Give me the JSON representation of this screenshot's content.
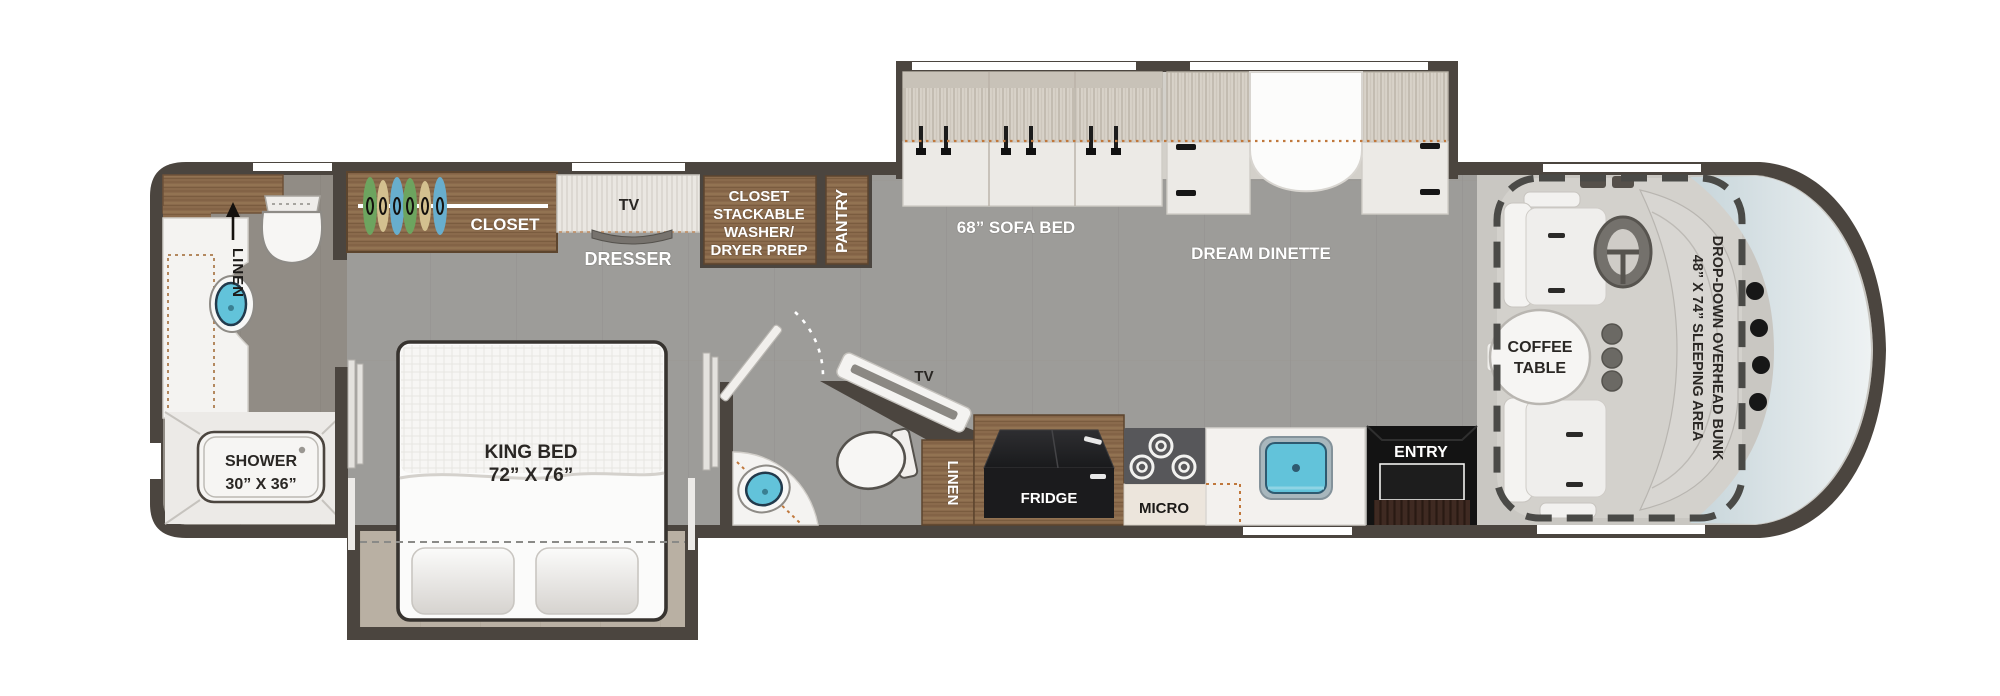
{
  "diagram": {
    "type": "rv-floorplan",
    "description": "Class A motorhome floor plan, side-aisle layout with two slide-outs"
  },
  "labels": {
    "rear_bath": {
      "linen": "LINEN",
      "shower_line1": "SHOWER",
      "shower_line2": "30” X 36”"
    },
    "bedroom": {
      "closet": "CLOSET",
      "tv": "TV",
      "dresser": "DRESSER",
      "king_line1": "KING BED",
      "king_line2": "72” X 76”"
    },
    "laundry": {
      "line1": "CLOSET",
      "line2": "STACKABLE",
      "line3": "WASHER/",
      "line4": "DRYER PREP",
      "pantry": "PANTRY"
    },
    "living": {
      "sofa": "68” SOFA BED",
      "dinette": "DREAM DINETTE"
    },
    "mid_bath": {
      "tv": "TV"
    },
    "kitchen": {
      "linen": "LINEN",
      "fridge": "FRIDGE",
      "micro": "MICRO",
      "entry": "ENTRY"
    },
    "front": {
      "coffee_line1": "COFFEE",
      "coffee_line2": "TABLE",
      "bunk_line1": "DROP-DOWN OVERHEAD BUNK",
      "bunk_line2": "48” X 74” SLEEPING AREA"
    }
  },
  "colors": {
    "wall": "#4b453f",
    "floor": "#9d9c99",
    "bath_floor": "#918c85",
    "slide_floor": "#b9b0a3",
    "wood": "#8a6a4c",
    "wood_edge": "#6e5138",
    "fabric": "#d8d2c9",
    "furniture_white": "#f3f1ee",
    "sink_blue": "#62c3da",
    "sink_rim": "#223a4c",
    "cooktop": "#57575a",
    "appliance_black": "#1b1b1d",
    "entry_black": "#131313",
    "step_brown": "#3f2a22",
    "accent_orange": "#c0783c",
    "windshield": "#d9e2e5",
    "seat": "#f2f1ef",
    "bunk_dash": "#4a4a47",
    "hanger_green": "#6da45f",
    "hanger_tan": "#d3c08f",
    "hanger_blue": "#68aecd"
  }
}
